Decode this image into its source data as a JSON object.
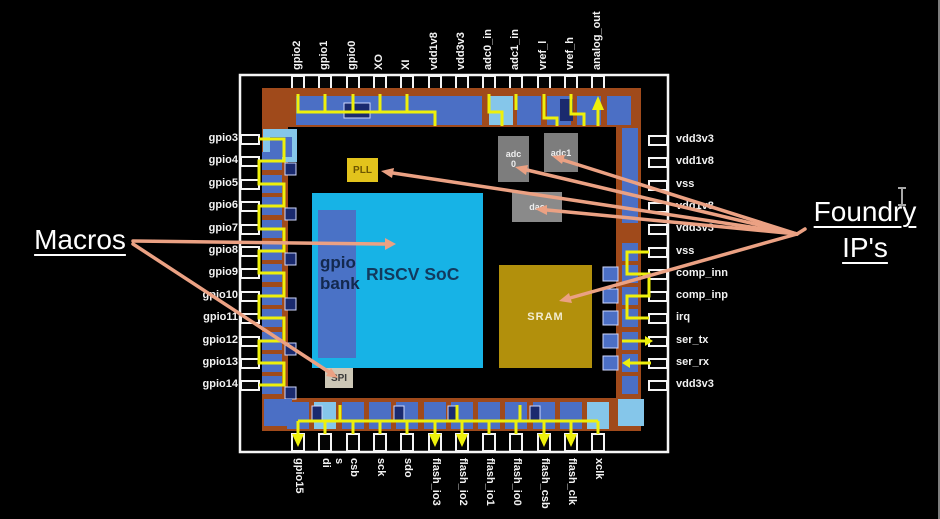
{
  "title": "RISCV SoC chip layout annotated with Macros and Foundry IP's",
  "annotations": {
    "macros": "Macros",
    "foundry_line1": "Foundry",
    "foundry_line2": "IP's"
  },
  "pins": {
    "top": [
      "gpio2",
      "gpio1",
      "gpio0",
      "XO",
      "XI",
      "vdd1v8",
      "vdd3v3",
      "adc0_in",
      "adc1_in",
      "vref_l",
      "vref_h",
      "analog_out"
    ],
    "left": [
      "gpio3",
      "gpio4",
      "gpio5",
      "gpio6",
      "gpio7",
      "gpio8",
      "gpio9",
      "gpio10",
      "gpio11",
      "gpio12",
      "gpio13",
      "gpio14"
    ],
    "right": [
      "vdd3v3",
      "vdd1v8",
      "vss",
      "vdd1v8",
      "vdd3v3",
      "vss",
      "comp_inn",
      "comp_inp",
      "irq",
      "ser_tx",
      "ser_rx",
      "vdd3v3"
    ],
    "bottom": [
      "gpio15",
      "s\ndi",
      "csb",
      "sck",
      "sdo",
      "flash_io3",
      "flash_io2",
      "flash_io1",
      "flash_io0",
      "flash_csb",
      "flash_clk",
      "xclk"
    ]
  },
  "blocks": {
    "riscv_soc": "RISCV SoC",
    "gpio_bank": "gpio\nbank",
    "sram": "SRAM",
    "adc0": "adc\n0",
    "adc1": "adc1",
    "dac": "dac",
    "pll": "PLL",
    "spi": "SPI"
  },
  "colors": {
    "background": "#000000",
    "die_orange": "#a04a1b",
    "pad_blue": "#4b6fc5",
    "pad_light_blue": "#85c6ea",
    "pad_navy": "#1a2a6e",
    "riscv_cyan": "#17b3e6",
    "gpio_bank_blue": "#4a72c6",
    "sram_gold": "#b2900c",
    "ip_gray": "#7d7d7d",
    "pll_yellow": "#e2c31c",
    "spi_beige": "#cdc7b6",
    "highlight_yellow": "#eef00b",
    "arrow_salmon": "#eba183",
    "package_white": "#f5f5f5"
  }
}
